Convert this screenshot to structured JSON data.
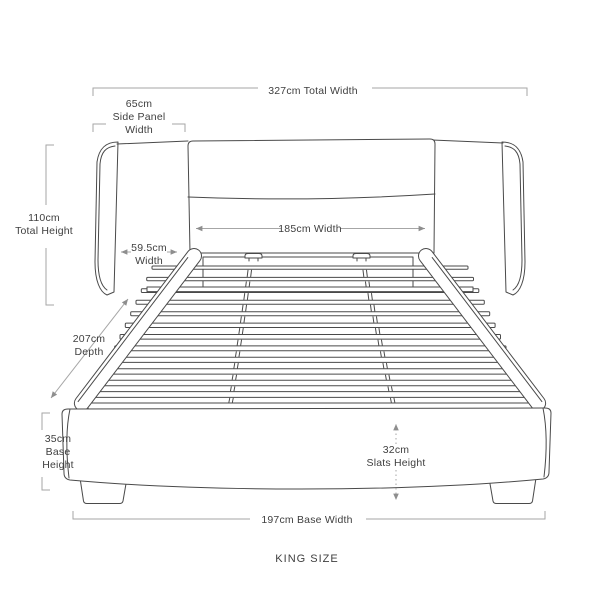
{
  "diagram": {
    "subject": "Upholstered wing bed frame with slatted base, front view dimension drawing",
    "slat_count": 13
  },
  "annotations": {
    "total_width": {
      "text": "327cm Total Width"
    },
    "side_panel_width": {
      "lines": [
        "65cm",
        "Side Panel",
        "Width"
      ]
    },
    "total_height": {
      "lines": [
        "110cm",
        "Total Height"
      ]
    },
    "wing_width": {
      "lines": [
        "59.5cm",
        "Width"
      ]
    },
    "mattress_width": {
      "text": "185cm Width"
    },
    "depth": {
      "lines": [
        "207cm",
        "Depth"
      ]
    },
    "base_height": {
      "lines": [
        "35cm",
        "Base",
        "Height"
      ]
    },
    "slats_height": {
      "lines": [
        "32cm",
        "Slats Height"
      ]
    },
    "base_width": {
      "text": "197cm Base Width"
    },
    "size_label": "KING SIZE"
  },
  "colors": {
    "background": "#ffffff",
    "outline": "#4a4a4a",
    "dimension_line": "#a6a6a6",
    "dimension_arrow": "#8e8e8e",
    "label_text": "#3f3f3f"
  }
}
